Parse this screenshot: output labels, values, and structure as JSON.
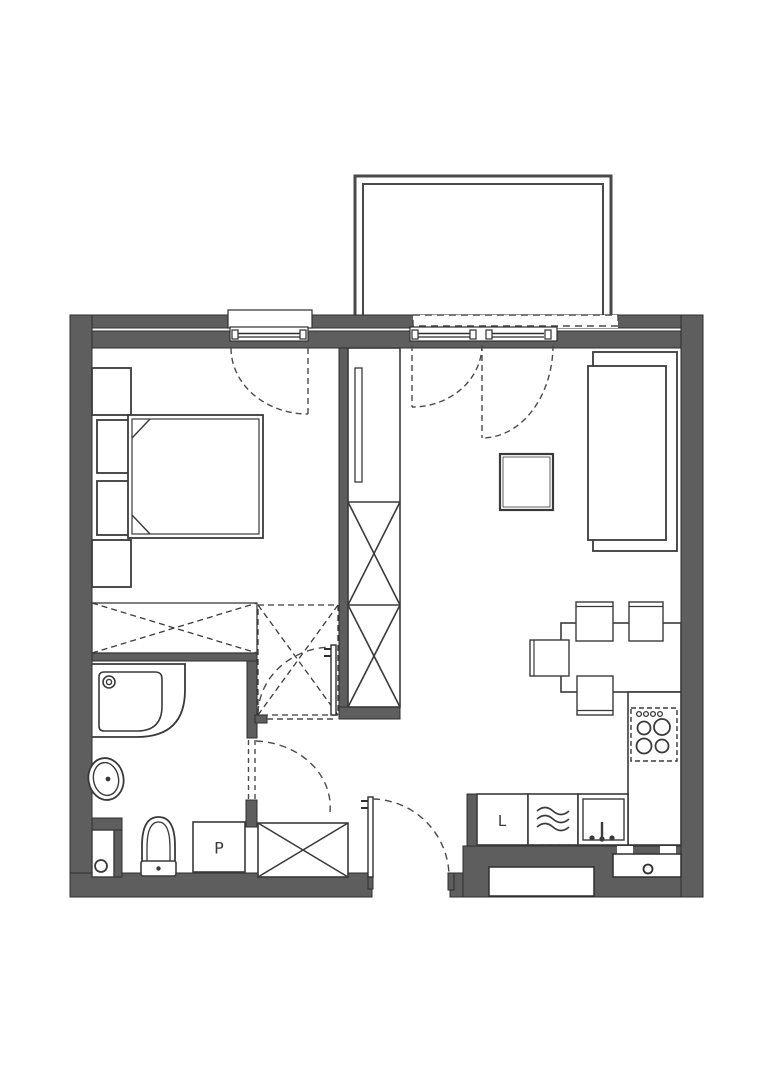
{
  "plan": {
    "labels": {
      "fridge": "L",
      "washing_machine": "P"
    },
    "colors": {
      "wall": "#5e5e5e",
      "line": "#3a3a3a",
      "background": "#ffffff"
    }
  }
}
